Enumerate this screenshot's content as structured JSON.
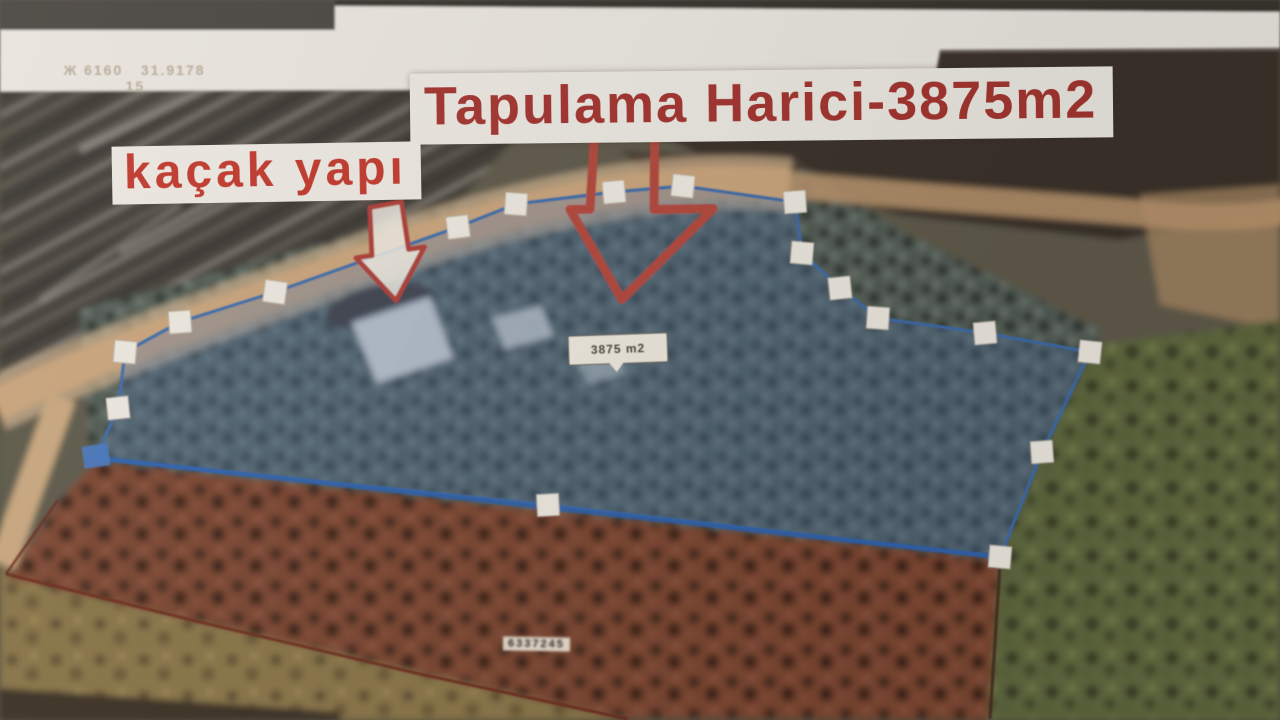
{
  "photo": {
    "coordinates_text": "Ж 6160   31.9178",
    "coordinates_secondary": "15"
  },
  "annotations": {
    "title_label": "Tapulama Harici-3875m2",
    "illegal_building_label": "kaçak yapı",
    "area_callout_label": "3875 m2",
    "parcel_tag_label": "6337245"
  },
  "map": {
    "kind": "aerial-photo-with-cadastral-annotation",
    "parcel_outline_color": "#3e6cab",
    "parcel_fill_color": "rgba(74,116,170,0.32)",
    "arrow_color": "#b24a3e",
    "annotation_text_color": "#a33530",
    "vertex_marker_color": "#ece8df",
    "field_boundary_color": "#6f2b1e"
  }
}
